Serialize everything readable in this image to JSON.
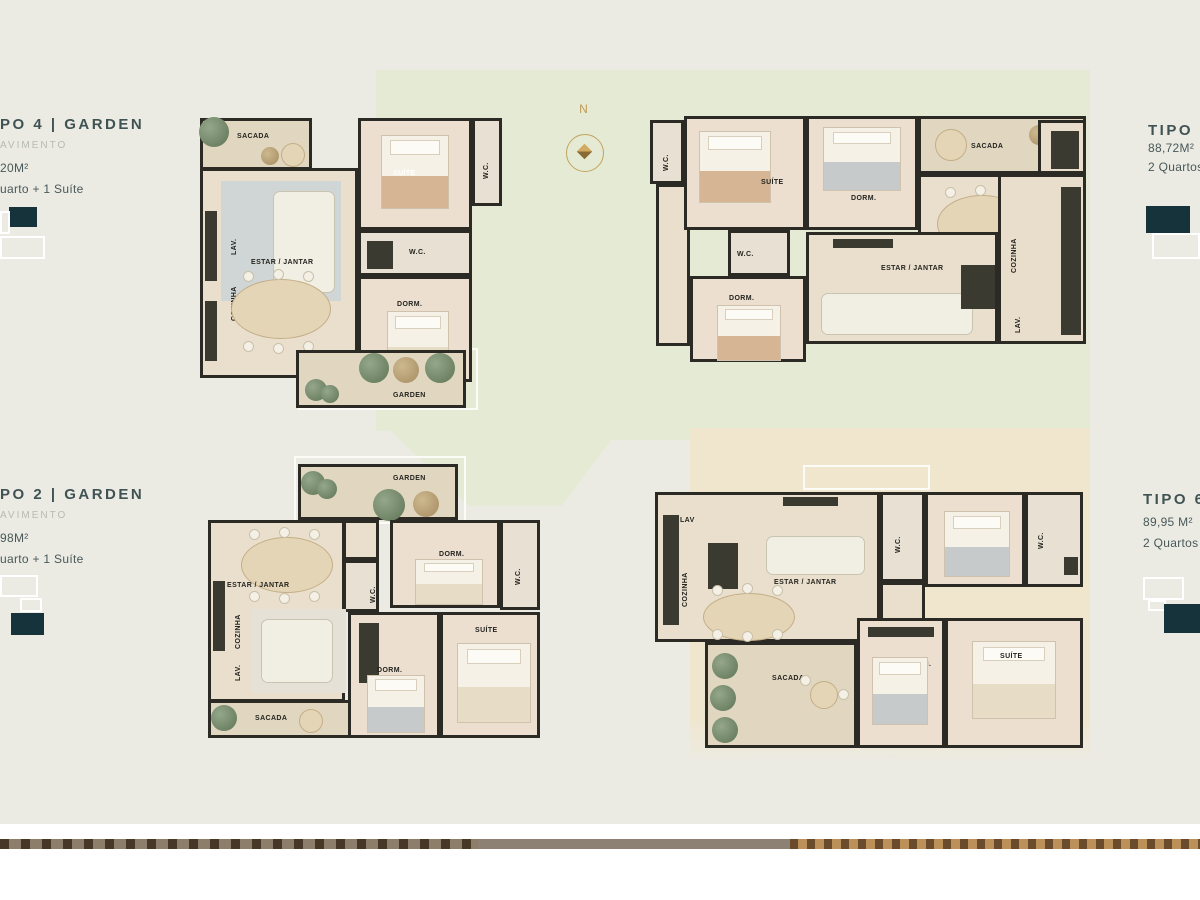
{
  "page": {
    "compass_label": "N",
    "colors": {
      "canvas": "#ecebe3",
      "green_area": "#e4ead3",
      "tan_area": "#f0e6cd",
      "heading_text": "#3f5254",
      "muted_text": "#b6bab2",
      "keyplan_dark": "#16333b",
      "compass_gold": "#c09a58",
      "wall": "#2b2a24"
    }
  },
  "panels": {
    "tipo4": {
      "title": "PO 4 | GARDEN",
      "subtitle": "AVIMENTO",
      "area": "20M²",
      "program": "uarto + 1 Suíte"
    },
    "tipo2": {
      "title": "PO 2 | GARDEN",
      "subtitle": "AVIMENTO",
      "area": "98M²",
      "program": "uarto + 1 Suíte"
    },
    "tipo8": {
      "title": "TIPO 8",
      "area": "88,72M²",
      "program": "2 Quartos"
    },
    "tipo6": {
      "title": "TIPO 6",
      "area": "89,95 M²",
      "program": "2 Quartos"
    }
  },
  "plans": {
    "tl": {
      "labels": {
        "sacada": "SACADA",
        "lav": "LAV.",
        "cozinha": "COZINHA",
        "estar": "ESTAR / JANTAR",
        "suite": "SUÍTE",
        "wc1": "W.C.",
        "wc2": "W.C.",
        "dorm": "DORM.",
        "garden": "GARDEN"
      }
    },
    "tr": {
      "labels": {
        "wc1": "W.C.",
        "suite": "SUÍTE",
        "dorm1": "DORM.",
        "sacada": "SACADA",
        "cozinha": "COZINHA",
        "lav": "LAV.",
        "estar": "ESTAR / JANTAR",
        "wc2": "W.C.",
        "dorm2": "DORM."
      }
    },
    "bl": {
      "labels": {
        "garden": "GARDEN",
        "dorm1": "DORM.",
        "wc1": "W.C.",
        "wc2": "W.C.",
        "estar": "ESTAR / JANTAR",
        "cozinha": "COZINHA",
        "lav": "LAV.",
        "sacada": "SACADA",
        "dorm2": "DORM.",
        "suite": "SUÍTE"
      }
    },
    "br": {
      "labels": {
        "lav": "LAV",
        "cozinha": "COZINHA",
        "estar": "ESTAR / JANTAR",
        "wc1": "W.C.",
        "dorm1": "DORM.",
        "wc2": "W.C.",
        "suite": "SUÍTE",
        "dorm2": "DORM.",
        "sacada": "SACADA"
      }
    }
  }
}
